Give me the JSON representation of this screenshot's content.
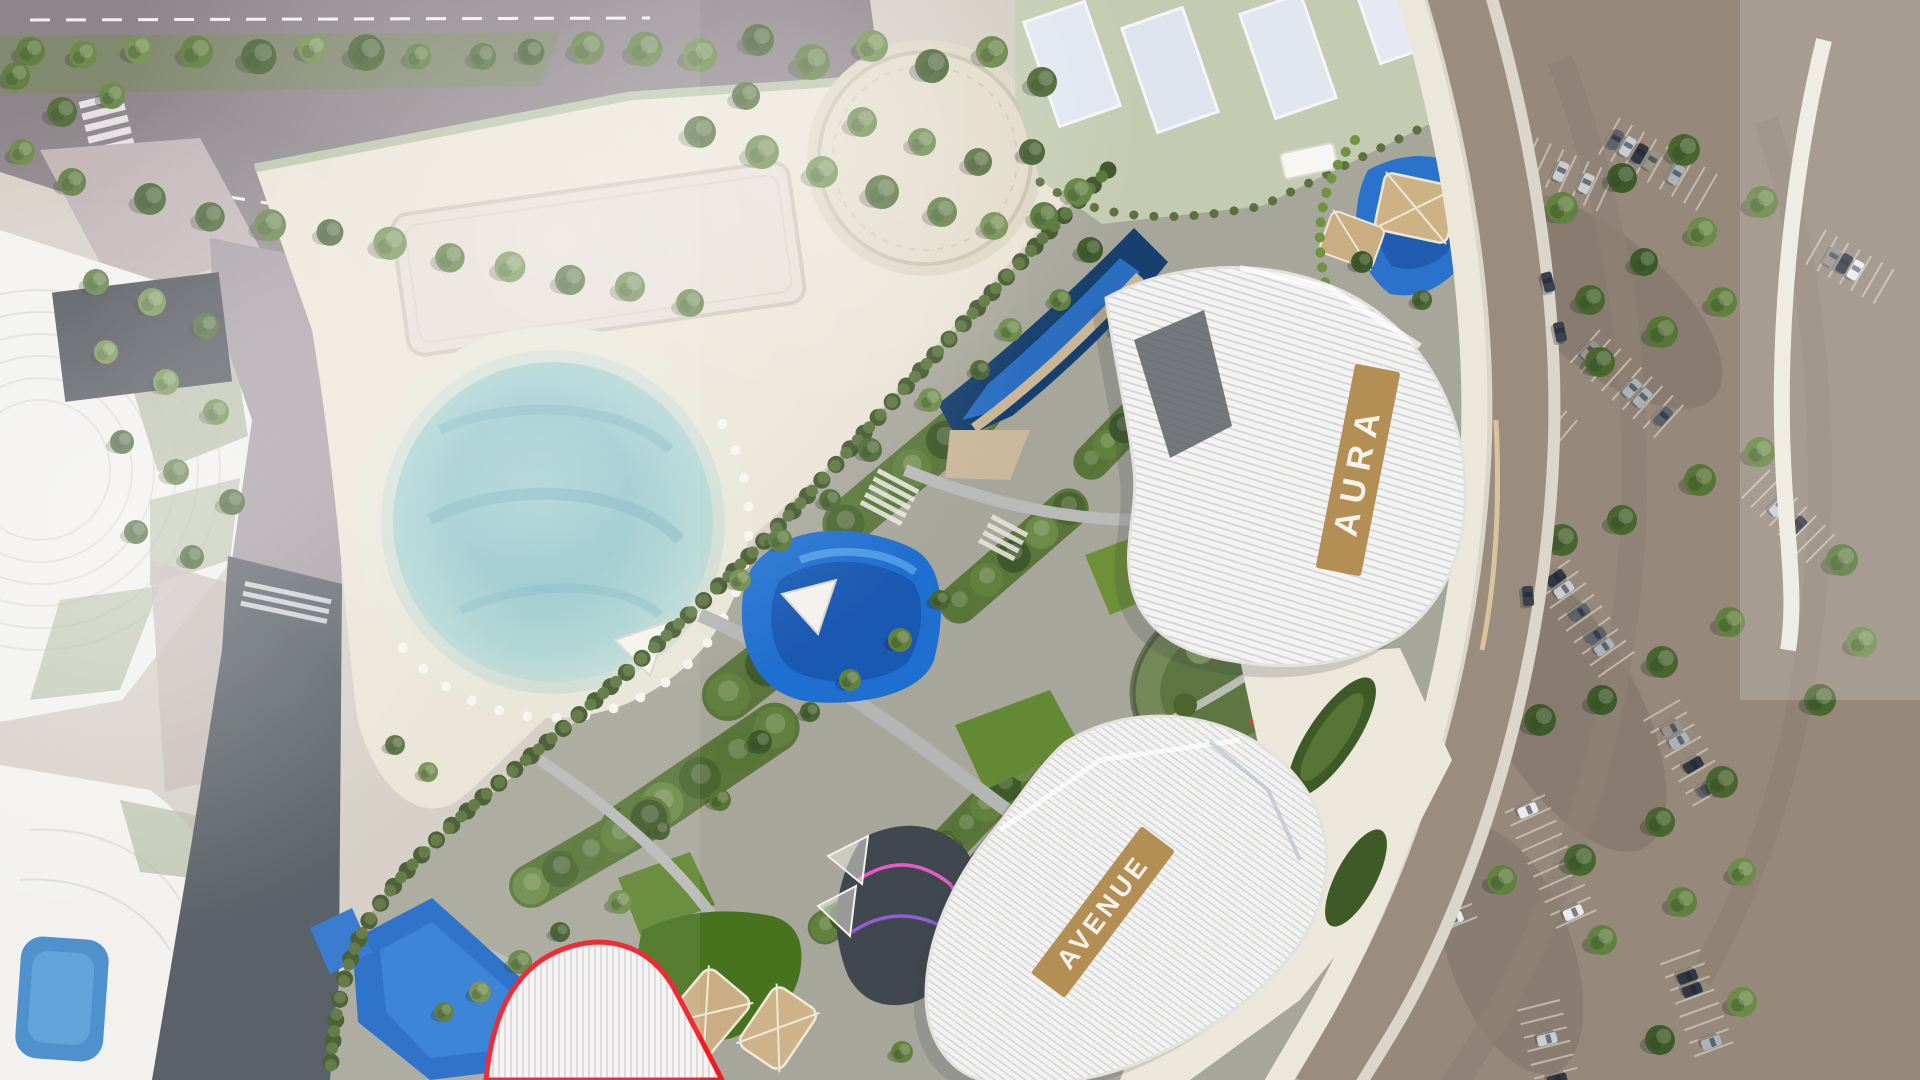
{
  "scene": {
    "type": "masterplan-aerial-render",
    "description": "Aerial 3D rendering of a mixed-use resort masterplan with beach club lagoon, amenity pools, two labeled residential buildings and a highlighted plot"
  },
  "buildings": {
    "aura": {
      "label": "AURA",
      "banner_color": "#b38e55",
      "text_color": "#f7f3ea"
    },
    "avenue": {
      "label": "AVENUE",
      "banner_color": "#b38e55",
      "text_color": "#f7f3ea"
    },
    "highlighted": {
      "outline_color": "#ee1b24"
    }
  },
  "areas": [
    "beach-club-deck",
    "lagoon-pool",
    "sun-lounger-court",
    "circular-plaza",
    "event-lawn",
    "sports-courts",
    "amenity-gardens",
    "resort-pools",
    "kids-play-area",
    "pond-garden",
    "podium-garden",
    "mall-rooftop",
    "service-road",
    "perimeter-road",
    "parking-lot",
    "tree-belt"
  ],
  "palette": {
    "ground": "#d3cdc4",
    "deck": "#e9e3d4",
    "deck_light": "#f3eee2",
    "road_mauve": "#847b81",
    "road_dark": "#4e545c",
    "road_boundary": "#9a8d80",
    "sidewalk": "#dcd6ca",
    "parking": "#96897c",
    "parking_stripe": "#cdc5b7",
    "lagoon_edge": "#bdd8d3",
    "lagoon_mid": "#8ec2c8",
    "lagoon_deep": "#6fafbe",
    "beach": "#e7e5d6",
    "pool_deep": "#17406e",
    "pool_bright": "#2277d8",
    "pool_light": "#58a3e8",
    "green_dark": "#3f5a2a",
    "green": "#567536",
    "green_light": "#6d8a48",
    "hedge": "#46602c",
    "pale_tree": "#c9cfb8",
    "lawn": "#c3ccb2",
    "court": "#e2e6ef",
    "tan_canopy": "#cbb28a",
    "building": "#f4f3f0",
    "ridge": "#ccd2db",
    "white_plaza": "#ece7db",
    "play_dark": "#41474f",
    "play_pink": "#e35cc8",
    "play_purple": "#8f5fd6"
  }
}
